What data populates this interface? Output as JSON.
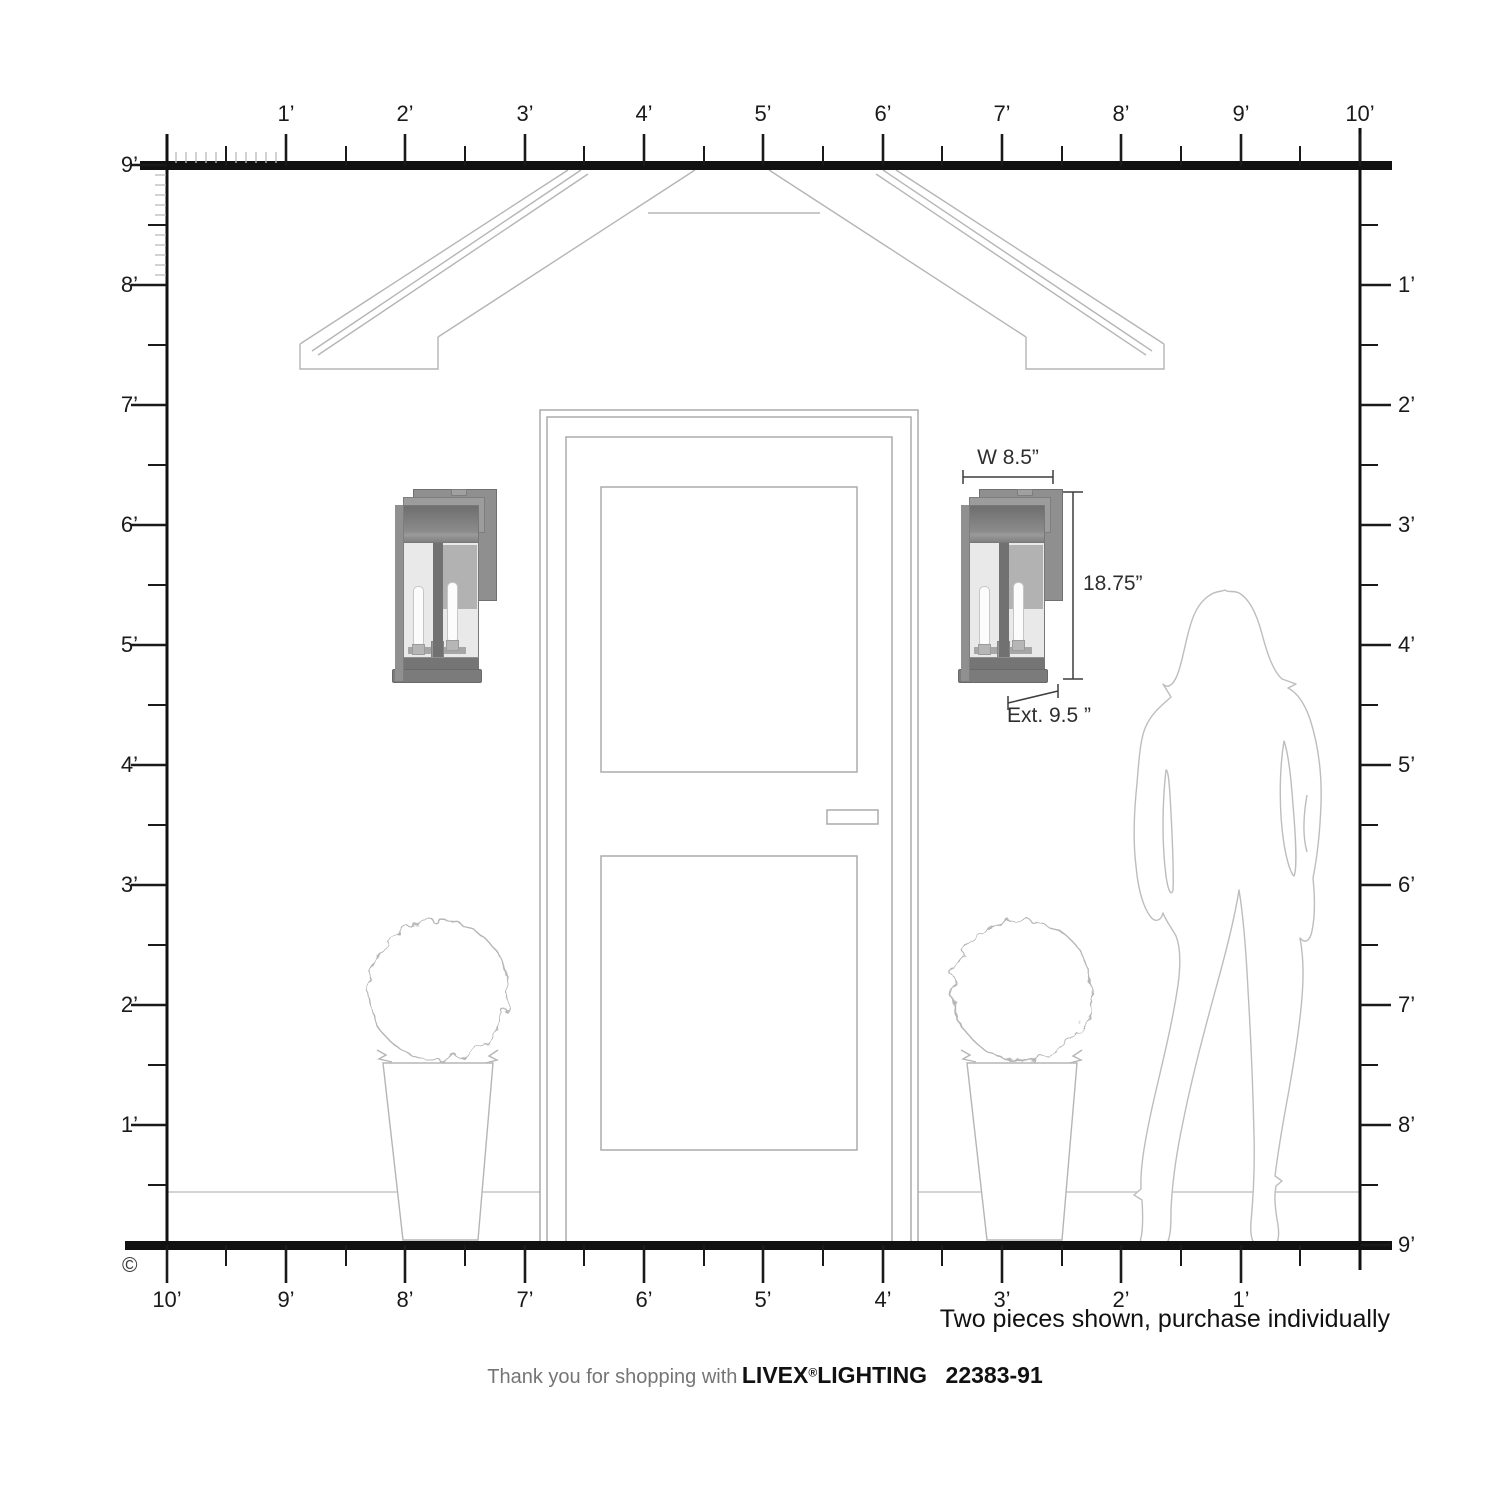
{
  "copyright": "©",
  "rulers": {
    "top": {
      "labels": [
        "1’",
        "2’",
        "3’",
        "4’",
        "5’",
        "6’",
        "7’",
        "8’",
        "9’",
        "10’"
      ]
    },
    "left": {
      "labels": [
        "9’",
        "8’",
        "7’",
        "6’",
        "5’",
        "4’",
        "3’",
        "2’",
        "1’"
      ]
    },
    "right": {
      "labels": [
        "1’",
        "2’",
        "3’",
        "4’",
        "5’",
        "6’",
        "7’",
        "8’",
        "9’"
      ]
    },
    "bottom": {
      "labels": [
        "10’",
        "9’",
        "8’",
        "7’",
        "6’",
        "5’",
        "4’",
        "3’",
        "2’",
        "1’"
      ]
    }
  },
  "annotations": {
    "width": "W 8.5”",
    "height": "18.75”",
    "extension": "Ext. 9.5 ”",
    "note": "Two pieces shown, purchase individually"
  },
  "footer": {
    "thanks": "Thank you for shopping with",
    "brand": "LIVEX",
    "registered": "®",
    "brand2": "LIGHTING",
    "model": "22383-91"
  }
}
